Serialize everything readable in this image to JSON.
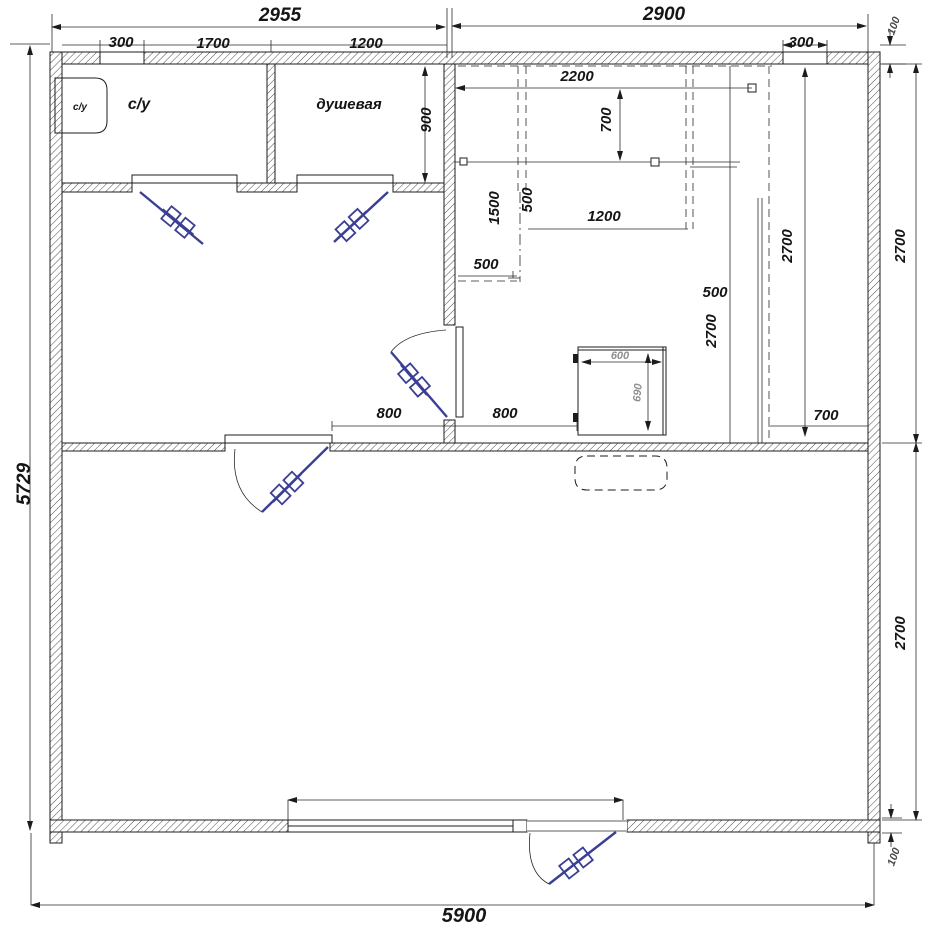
{
  "drawing": {
    "kind": "floor-plan",
    "rooms": {
      "toilet_cabin": "с/у",
      "toilet_room": "с/у",
      "shower_room": "душевая"
    },
    "dims": {
      "top_left_span": "2955",
      "top_right_span": "2900",
      "top_offset_100": "100",
      "window_left": "300",
      "seg_1700": "1700",
      "seg_1200": "1200",
      "window_right": "300",
      "shower_900": "900",
      "bench_2200": "2200",
      "bench_700": "700",
      "k_1500": "1500",
      "k_500_v": "500",
      "k_1200": "1200",
      "k_500_h": "500",
      "s_500": "500",
      "s_2700": "2700",
      "room_2700": "2700",
      "right_2700_top": "2700",
      "corner_700": "700",
      "right_2700_bottom": "2700",
      "bottom_offset_100": "100",
      "left_5729": "5729",
      "bottom_5900": "5900",
      "door_800_l": "800",
      "door_800_r": "800",
      "stove_600": "600",
      "stove_690": "690"
    },
    "colors": {
      "line": "#1c1c1c",
      "door": "#3b3f94",
      "stove_dim_text": "#8f8f8f",
      "background": "#ffffff"
    }
  }
}
